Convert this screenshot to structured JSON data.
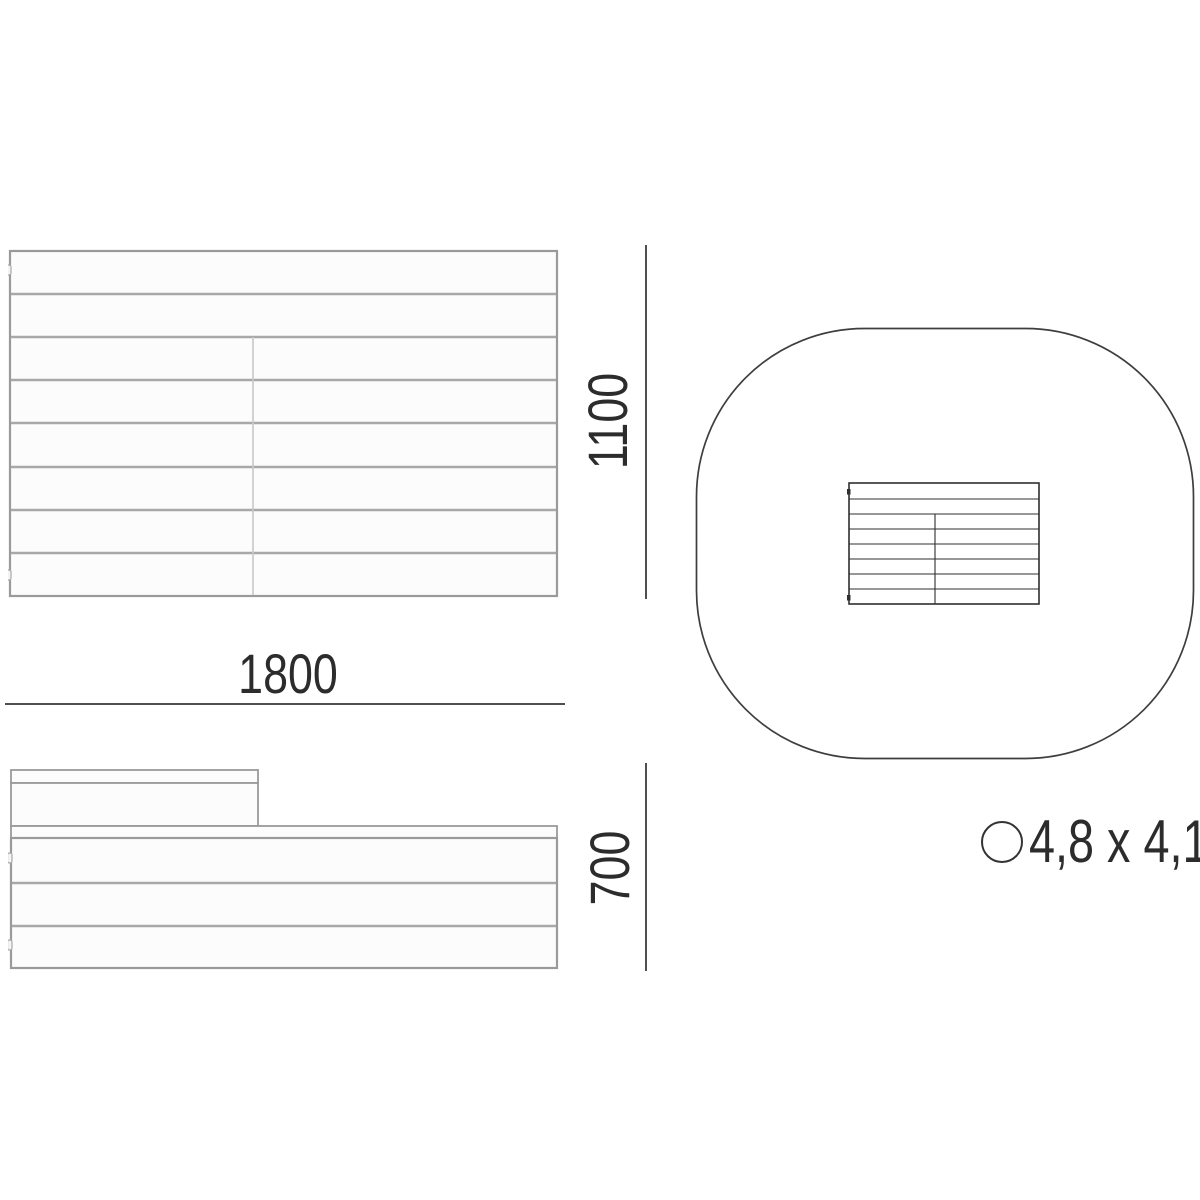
{
  "drawing": {
    "dimensions": {
      "width": "1800",
      "height": "1100",
      "depth": "700"
    },
    "safety_zone": {
      "label": "4,8 x 4,1"
    }
  }
}
